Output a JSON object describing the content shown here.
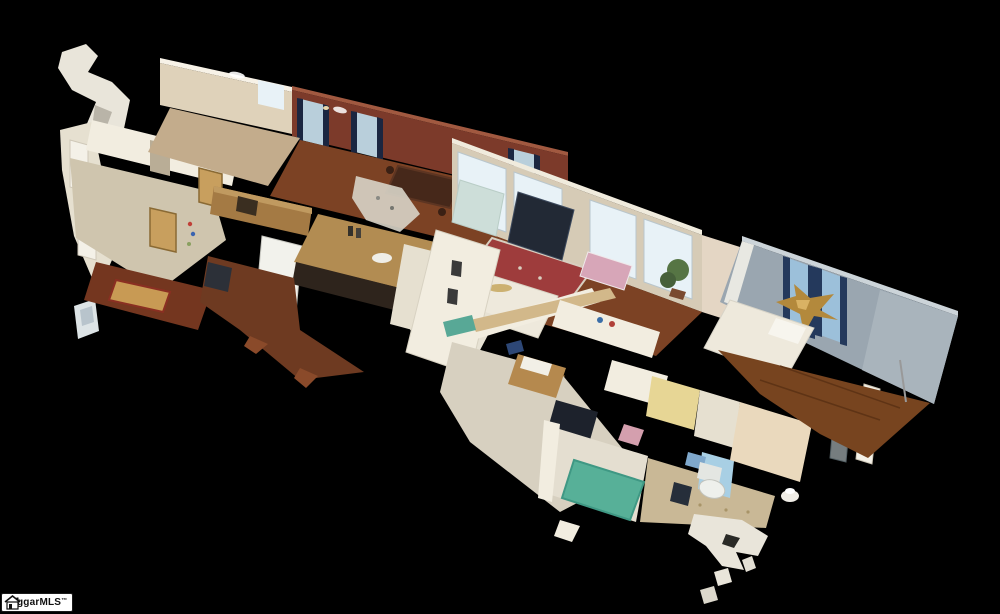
{
  "scene": {
    "description": "Matterport-style 3D dollhouse cutaway view of a single-story house floor plan, tilted diagonally on a black background, with incomplete scan fragments floating around the edges",
    "elements": [
      "entry-room-carpet",
      "hallway",
      "kitchen",
      "refrigerator",
      "kitchen-island",
      "dining-room-maroon-wall",
      "dining-table",
      "living-room",
      "window-wall",
      "tufted-chair",
      "sofa",
      "dark-piano",
      "red-oriental-rug",
      "ceiling-fan",
      "potted-plant",
      "gray-bedroom",
      "curtained-windows",
      "gold-starfish-decor",
      "bed",
      "bedroom-carpet",
      "dresser",
      "teal-rug-bathroom",
      "toilet",
      "shower-curtain",
      "scan-fragments"
    ],
    "background": "#000000"
  },
  "watermark": {
    "text": "ggarMLS",
    "tm": "™",
    "bg": "#ffffff",
    "fg": "#111111"
  },
  "palette": {
    "black": "#000000",
    "wallCream": "#dfd2ba",
    "wallCreamBright": "#f7f2e7",
    "wallCreamLit": "#f0ebdd",
    "wallTan": "#d6cbb6",
    "wallWhite": "#f2ede0",
    "wallWhiteDim": "#e6e0d0",
    "wallMaroon": "#7c3a2a",
    "wallMaroonLit": "#a15940",
    "wallGray": "#9aa6b0",
    "wallGrayLit": "#a9b4bc",
    "wallGrayLip": "#ccd4d9",
    "wallYellow": "#e7d695",
    "wallPink": "#e4d6c4",
    "floorWoodDark": "#6e3a21",
    "floorWood": "#7c4224",
    "floorWoodRed": "#74361f",
    "floorWoodBed": "#77441f",
    "floorHallTan": "#c3ac8c",
    "carpetBeige": "#cfc5ae",
    "carpetLight": "#d7d0c0",
    "floorPale": "#e4ded0",
    "floorMosaic": "#c9b896",
    "windowBright": "#e8f2f7",
    "windowPane": "#b9cfdb",
    "windowSky": "#9cc0da",
    "curtainNavy": "#1b2640",
    "curtainNavy2": "#24395c",
    "rugRed": "#9e3c3c",
    "rugTeal": "#57b098",
    "rugGold": "#c89a54",
    "chairBlue": "#cdded9",
    "sofaWhite": "#eee9dc",
    "sofaWhite2": "#e7e2d4",
    "pianoDark": "#222935",
    "furnDark": "#2c3038",
    "tvDark": "#1d222c",
    "pink": "#d7a6b8",
    "pink2": "#d49fae",
    "plantGreen": "#567544",
    "gold": "#b3893c",
    "goldLit": "#d9b264",
    "woodCab": "#a47a44",
    "woodCabLit": "#c09a60",
    "oak": "#c89f5e",
    "island": "#b28c52",
    "islandBase": "#2e241c",
    "dresser": "#b5894e",
    "fridge": "#f2f2ec",
    "toiletWhite": "#eef0ec",
    "showerBlue": "#a8cfe4",
    "matBlue": "#7fa8cc",
    "binBlue": "#3f6fa0",
    "navyBag": "#2d4776",
    "orange": "#cf7a2e",
    "teal": "#58a896",
    "mapBlue": "#9fb9c4",
    "tableDark": "#46281a",
    "fragment": "#e9e5da",
    "fragmentCool": "#dde4e6",
    "glint": "#ffffff",
    "tanBeam": "#d2b88a",
    "closetTan": "#ead9bd",
    "doorWhite": "#f4f1e8"
  }
}
